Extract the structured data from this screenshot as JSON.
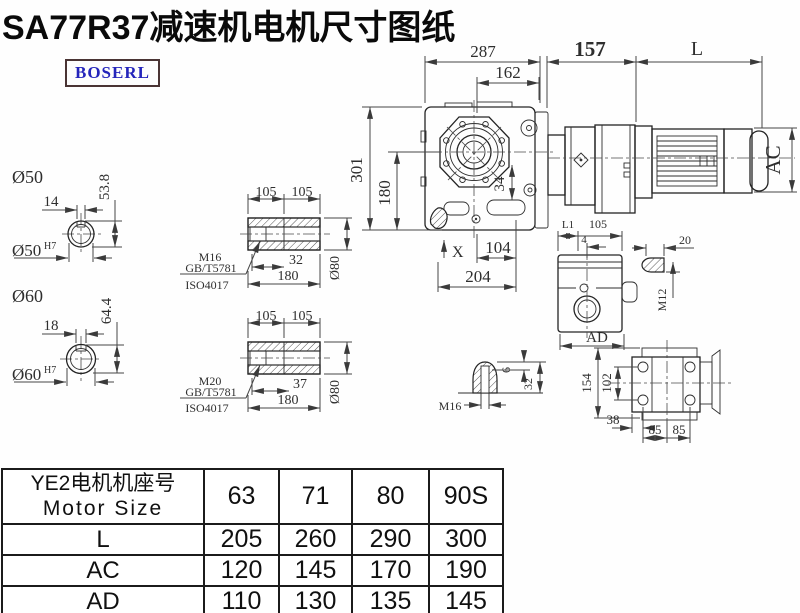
{
  "title": "SA77R37减速机电机尺寸图纸",
  "logo": "BOSERL",
  "main": {
    "d287": "287",
    "d162": "162",
    "d157": "157",
    "dL": "L",
    "d301": "301",
    "d180": "180",
    "d34": "34",
    "dAC": "AC",
    "dX": "X",
    "d104": "104",
    "d204": "204"
  },
  "shaft50": {
    "label": "Ø50",
    "w": "14",
    "h": "53.8",
    "bore": "Ø50",
    "bore_sup": "H7"
  },
  "shaft60": {
    "label": "Ø60",
    "w": "18",
    "h": "64.4",
    "bore": "Ø60",
    "bore_sup": "H7"
  },
  "sleeve1": {
    "t1": "105",
    "t2": "105",
    "screw": "M16",
    "std1": "GB/T5781",
    "std2": "ISO4017",
    "depth": "32",
    "len": "180",
    "dia": "Ø80"
  },
  "sleeve2": {
    "t1": "105",
    "t2": "105",
    "screw": "M20",
    "std1": "GB/T5781",
    "std2": "ISO4017",
    "depth": "37",
    "len": "180",
    "dia": "Ø80"
  },
  "side": {
    "l1": "L1",
    "top": "105",
    "off": "4",
    "ad": "AD",
    "plug_len": "20",
    "plug": "M12"
  },
  "cone": {
    "tip": "6",
    "h": "32",
    "thread": "M16"
  },
  "topview": {
    "h1": "154",
    "h2": "102",
    "off": "38",
    "p1": "85",
    "p2": "85"
  },
  "table": {
    "header": {
      "line1": "YE2电机机座号",
      "line2": "Motor Size",
      "cols": [
        "63",
        "71",
        "80",
        "90S"
      ]
    },
    "rows": [
      {
        "label": "L",
        "values": [
          "205",
          "260",
          "290",
          "300"
        ]
      },
      {
        "label": "AC",
        "values": [
          "120",
          "145",
          "170",
          "190"
        ]
      },
      {
        "label": "AD",
        "values": [
          "110",
          "130",
          "135",
          "145"
        ]
      }
    ]
  }
}
